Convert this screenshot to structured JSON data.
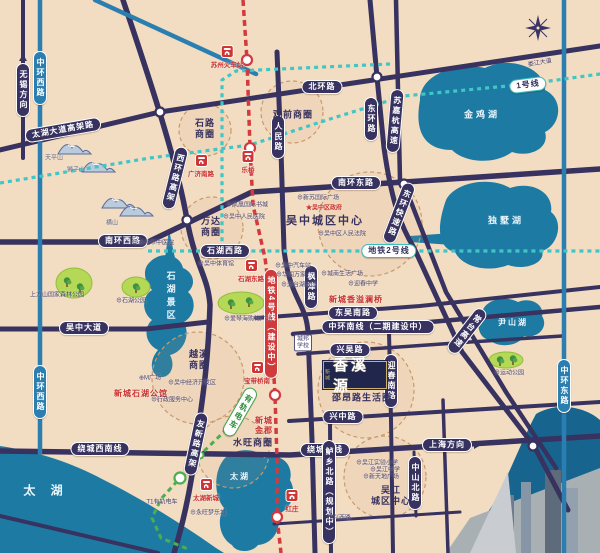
{
  "logo": {
    "t": "香溪源",
    "mini": "新城",
    "sub_label": "邵昂路生活圈"
  },
  "colors": {
    "road": "#37325f",
    "blue_road": "#2b7fb0",
    "metro_teal": "#3fc6c6",
    "line4_red": "#d23a3e",
    "tram_green": "#4cae4c",
    "lake": "#1d7ba3",
    "park": "#b5d957",
    "ring": "#c89a6b",
    "bg": "#f2dcc2",
    "brand_red": "#c9312f"
  },
  "road_labels": [
    {
      "t": "中环西路",
      "x": 40,
      "y": 78,
      "c": "blue vert"
    },
    {
      "t": "中环西路",
      "x": 40,
      "y": 392,
      "c": "blue vert"
    },
    {
      "t": "中环东路",
      "x": 564,
      "y": 386,
      "c": "blue vert"
    },
    {
      "t": "无锡方向",
      "x": 23,
      "y": 90,
      "c": "vert",
      "a": "up"
    },
    {
      "t": "太湖大道高架路",
      "x": 63,
      "y": 130,
      "r": -10
    },
    {
      "t": "北环路",
      "x": 322,
      "y": 87
    },
    {
      "t": "南环西路",
      "x": 123,
      "y": 241
    },
    {
      "t": "西环路高架",
      "x": 175,
      "y": 178,
      "c": "vert",
      "r": 14
    },
    {
      "t": "人民路",
      "x": 278,
      "y": 137,
      "c": "vert"
    },
    {
      "t": "东环路",
      "x": 371,
      "y": 119,
      "c": "vert"
    },
    {
      "t": "苏嘉杭高速",
      "x": 395,
      "y": 121,
      "c": "vert",
      "r": 5
    },
    {
      "t": "南环东路",
      "x": 356,
      "y": 183
    },
    {
      "t": "东环快速路",
      "x": 399,
      "y": 213,
      "c": "vert",
      "r": 21
    },
    {
      "t": "石湖西路",
      "x": 225,
      "y": 251
    },
    {
      "t": "枫津路",
      "x": 311,
      "y": 287,
      "c": "vert"
    },
    {
      "t": "东吴南路",
      "x": 353,
      "y": 313
    },
    {
      "t": "中环南线（二期建设中）",
      "x": 378,
      "y": 327
    },
    {
      "t": "兴吴路",
      "x": 350,
      "y": 350
    },
    {
      "t": "迎春南路",
      "x": 391,
      "y": 381,
      "c": "vert"
    },
    {
      "t": "常台高速",
      "x": 467,
      "y": 331,
      "c": "vert",
      "r": 38
    },
    {
      "t": "兴中路",
      "x": 343,
      "y": 417
    },
    {
      "t": "吴中大道",
      "x": 84,
      "y": 328
    },
    {
      "t": "绕城西南线",
      "x": 100,
      "y": 449
    },
    {
      "t": "绕城南线",
      "x": 325,
      "y": 450
    },
    {
      "t": "上海方向",
      "x": 447,
      "y": 445,
      "a": "right"
    },
    {
      "t": "鲈乡北路（规划中）",
      "x": 329,
      "y": 492,
      "c": "vert"
    },
    {
      "t": "中山北路",
      "x": 415,
      "y": 483,
      "c": "vert"
    },
    {
      "t": "友新路高架",
      "x": 196,
      "y": 444,
      "c": "vert",
      "r": 12
    }
  ],
  "metro_labels": [
    {
      "t": "1号线",
      "x": 528,
      "y": 85,
      "c": "metrocap",
      "r": -7
    },
    {
      "t": "地铁2号线",
      "x": 389,
      "y": 251,
      "c": "metrocap"
    },
    {
      "t": "地铁4号线（建设中）",
      "x": 271,
      "y": 324,
      "c": "redcap vert"
    },
    {
      "t": "有轨电车",
      "x": 240,
      "y": 412,
      "c": "tramcap vert",
      "r": 30
    }
  ],
  "areas": [
    {
      "t": "石路\n商圈",
      "x": 205,
      "y": 129
    },
    {
      "t": "观前商圈",
      "x": 293,
      "y": 115
    },
    {
      "t": "万达\n商圈",
      "x": 211,
      "y": 227
    },
    {
      "t": "吴中城区中心",
      "x": 325,
      "y": 222,
      "c": "big"
    },
    {
      "t": "越溪\n商圈",
      "x": 199,
      "y": 360
    },
    {
      "t": "水旺商圈",
      "x": 253,
      "y": 443
    },
    {
      "t": "吴江\n城区中心",
      "x": 391,
      "y": 496
    },
    {
      "t": "邵昂路生活圈",
      "x": 362,
      "y": 398
    }
  ],
  "lake_labels": [
    {
      "t": "金鸡湖",
      "x": 482,
      "y": 115
    },
    {
      "t": "独墅湖",
      "x": 506,
      "y": 221
    },
    {
      "t": "尹山湖",
      "x": 513,
      "y": 323,
      "c": "sm"
    },
    {
      "t": "太 湖",
      "x": 46,
      "y": 491,
      "c": "big"
    },
    {
      "t": "太湖",
      "x": 240,
      "y": 477,
      "c": "sm"
    },
    {
      "t": "石湖景区",
      "x": 170,
      "y": 297,
      "c": "vert"
    }
  ],
  "stations": [
    {
      "t": "苏州火车站",
      "x": 227,
      "y": 57
    },
    {
      "t": "广济南路",
      "x": 201,
      "y": 166
    },
    {
      "t": "乐桥",
      "x": 248,
      "y": 162
    },
    {
      "t": "石湖东路",
      "x": 251,
      "y": 271
    },
    {
      "t": "宝带桥南",
      "x": 257,
      "y": 373
    },
    {
      "t": "红庄",
      "x": 292,
      "y": 501
    },
    {
      "t": "太湖新城",
      "x": 206,
      "y": 490
    }
  ],
  "projects": [
    {
      "t": "新城石湖公馆",
      "x": 141,
      "y": 394
    },
    {
      "t": "新城香溢澜桥",
      "x": 356,
      "y": 300
    },
    {
      "t": "新城\n金郡",
      "x": 264,
      "y": 426
    }
  ],
  "pois": [
    {
      "t": "天平山",
      "x": 54,
      "y": 159,
      "c": "mt"
    },
    {
      "t": "狮子山",
      "x": 76,
      "y": 171,
      "c": "mt"
    },
    {
      "t": "横山",
      "x": 112,
      "y": 224,
      "c": "mt"
    },
    {
      "t": "上方山国家森林公园",
      "x": 57,
      "y": 296
    },
    {
      "t": "⊕石湖公园",
      "x": 131,
      "y": 302
    },
    {
      "t": "⊕爱琴海购物广场",
      "x": 248,
      "y": 320
    },
    {
      "t": "⊕凤凰国际书城",
      "x": 247,
      "y": 206
    },
    {
      "t": "⊕吴中人民医院",
      "x": 244,
      "y": 218
    },
    {
      "t": "⊕新苏国际广场",
      "x": 318,
      "y": 199
    },
    {
      "t": "★吴中区政府",
      "x": 324,
      "y": 209,
      "c": "redpoi"
    },
    {
      "t": "⊕吴中区人民法院",
      "x": 342,
      "y": 235
    },
    {
      "t": "⊕吴中汽车站",
      "x": 293,
      "y": 267
    },
    {
      "t": "⊕华润万家",
      "x": 291,
      "y": 276
    },
    {
      "t": "⊕澹台湖公园",
      "x": 299,
      "y": 286
    },
    {
      "t": "⊕城南生活广场",
      "x": 342,
      "y": 275
    },
    {
      "t": "⊕迎春中学",
      "x": 363,
      "y": 285
    },
    {
      "t": "⊕苏州市中医院",
      "x": 153,
      "y": 244
    },
    {
      "t": "⊕吴中体育馆",
      "x": 216,
      "y": 265
    },
    {
      "t": "⊕M广场",
      "x": 150,
      "y": 379
    },
    {
      "t": "⊕吴中经济开发区",
      "x": 192,
      "y": 384
    },
    {
      "t": "⊕行政服务中心",
      "x": 172,
      "y": 401
    },
    {
      "t": "⊕吴江实验小学",
      "x": 377,
      "y": 464
    },
    {
      "t": "⊕吴江中学",
      "x": 385,
      "y": 471
    },
    {
      "t": "⊕新天地广场",
      "x": 381,
      "y": 478
    },
    {
      "t": "⊕永旺梦乐城",
      "x": 208,
      "y": 514
    },
    {
      "t": "⊕运动公园",
      "x": 509,
      "y": 374
    },
    {
      "t": "T1有轨电车",
      "x": 162,
      "y": 503
    },
    {
      "t": "江兴西路",
      "x": 339,
      "y": 519
    },
    {
      "t": "娄江大道",
      "x": 540,
      "y": 64,
      "r": -10
    },
    {
      "t": "城邦\n学校",
      "x": 303,
      "y": 343,
      "c": "box"
    }
  ]
}
